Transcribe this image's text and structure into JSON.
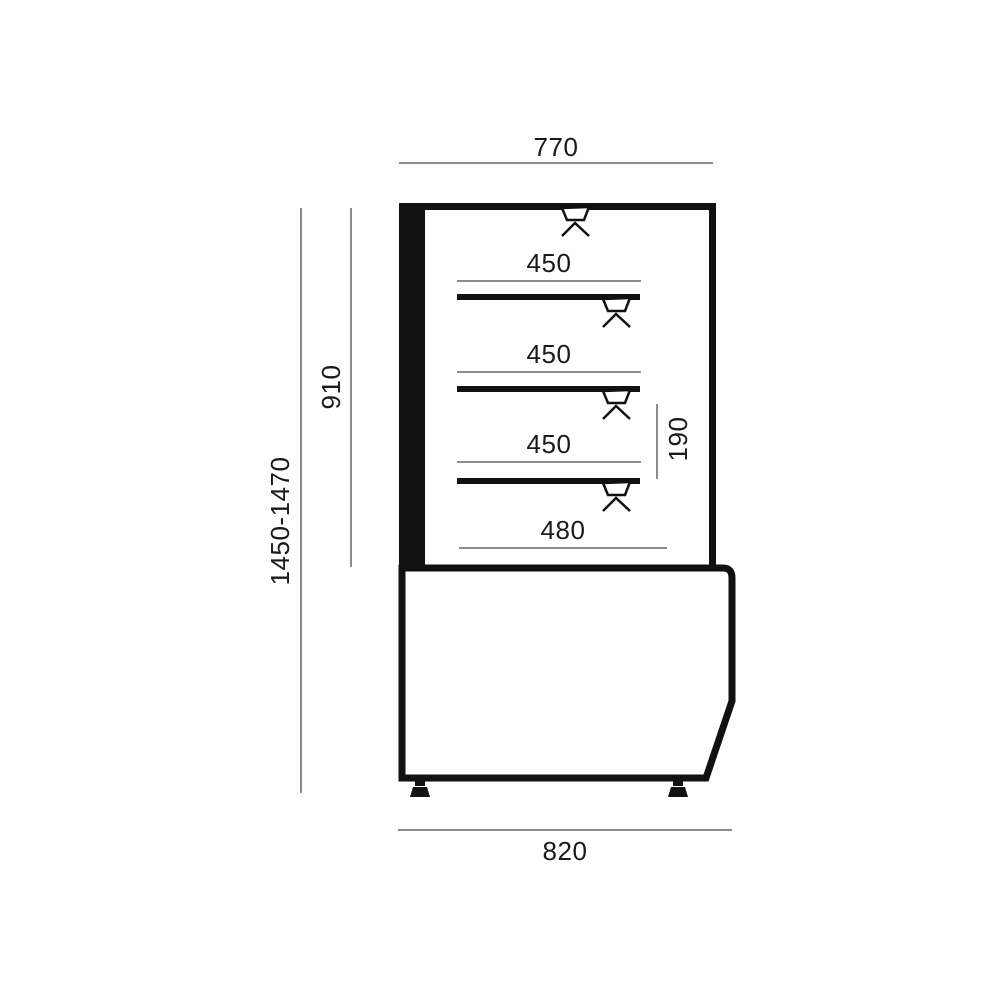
{
  "drawing": {
    "labels": {
      "top_width": "770",
      "overall_height": "1450-1470",
      "upper_height": "910",
      "shelf1_depth": "450",
      "shelf2_depth": "450",
      "shelf3_depth": "450",
      "shelf_gap": "190",
      "deck_depth": "480",
      "base_width": "820"
    },
    "colors": {
      "line": "#111111",
      "dimension_line": "#8c8c8c",
      "text": "#1a1a1a",
      "background": "#ffffff"
    }
  }
}
